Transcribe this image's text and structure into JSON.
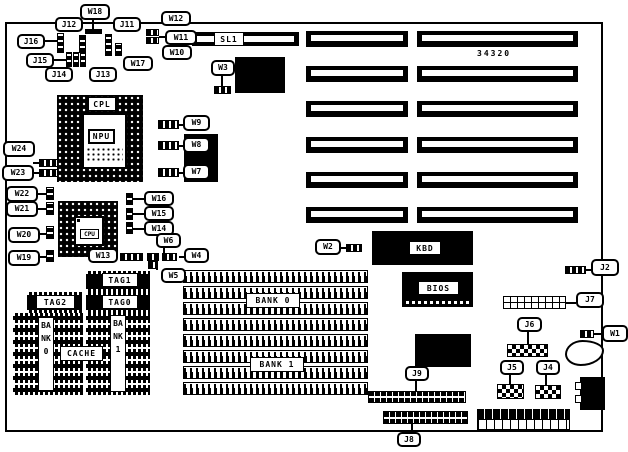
{
  "colors": {
    "line": "#000000",
    "background": "#ffffff"
  },
  "board_number": "34320",
  "labels": {
    "w18": "W18",
    "j12": "J12",
    "j11": "J11",
    "j16": "J16",
    "j15": "J15",
    "j14": "J14",
    "j13": "J13",
    "w17": "W17",
    "w12": "W12",
    "w11": "W11",
    "w10": "W10",
    "sl1": "SL1",
    "w3": "W3",
    "cpl": "CPL",
    "npu": "NPU",
    "cpu": "CPU",
    "w9": "W9",
    "w8": "W8",
    "w7": "W7",
    "w24": "W24",
    "w23": "W23",
    "w22": "W22",
    "w21": "W21",
    "w20": "W20",
    "w19": "W19",
    "w16": "W16",
    "w15": "W15",
    "w14": "W14",
    "w13": "W13",
    "w6": "W6",
    "w5": "W5",
    "w4": "W4",
    "w2": "W2",
    "tag1": "TAG1",
    "tag2": "TAG2",
    "tag0": "TAG0",
    "cache": "CACHE",
    "bank0_chips": "BANK0",
    "bank1_chips": "BANK1",
    "bank0_simm": "BANK 0",
    "bank1_simm": "BANK 1",
    "kbd": "KBD",
    "bios": "BIOS",
    "j2": "J2",
    "j7": "J7",
    "j6": "J6",
    "w1": "W1",
    "j5": "J5",
    "j4": "J4",
    "j9": "J9",
    "j8": "J8"
  }
}
